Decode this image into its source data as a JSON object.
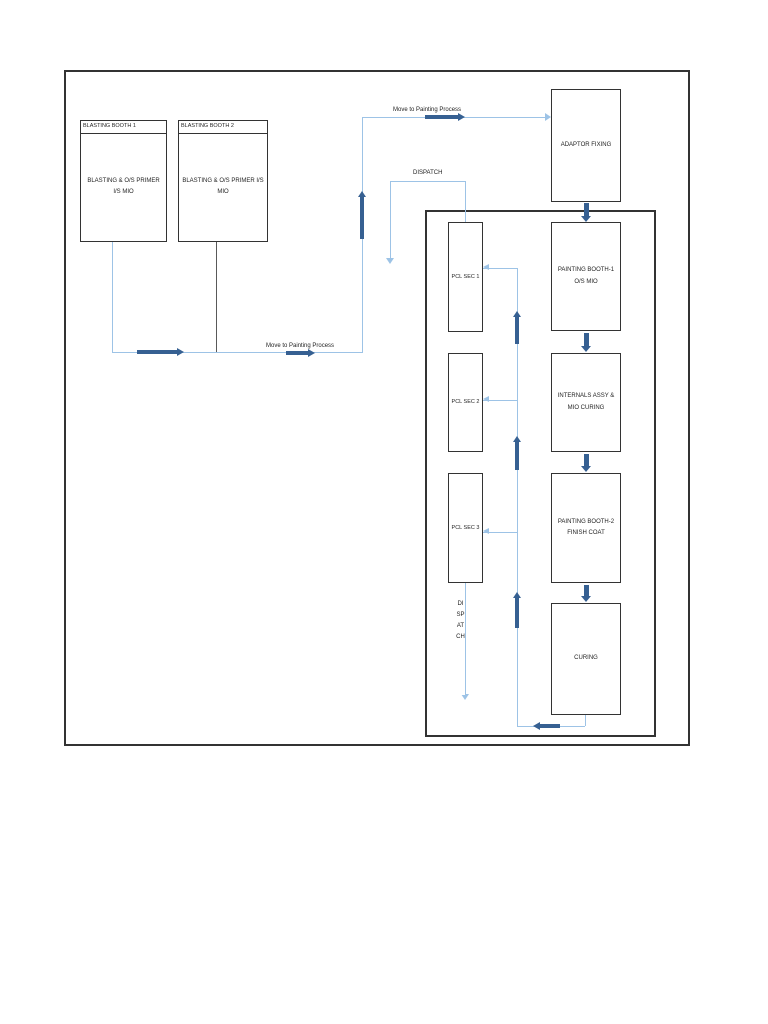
{
  "colors": {
    "line_light": "#9DC3E6",
    "arrow_dark": "#366092",
    "box_border": "#333333",
    "text": "#1f1f1f",
    "booth2_drop": "#595959"
  },
  "boxes": {
    "blasting_booth_1": {
      "header": "BLASTING BOOTH 1",
      "body_line1": "BLASTING & O/S PRIMER",
      "body_line2": "I/S MIO"
    },
    "blasting_booth_2": {
      "header": "BLASTING BOOTH 2",
      "body_line1": "BLASTING & O/S PRIMER I/S",
      "body_line2": "MIO"
    },
    "adaptor_fixing": {
      "label": "ADAPTOR FIXING"
    },
    "pcl_sec_1": {
      "label": "PCL SEC  1"
    },
    "pcl_sec_2": {
      "label": "PCL SEC  2"
    },
    "pcl_sec_3": {
      "label": "PCL SEC  3"
    },
    "painting_booth_1": {
      "line1": "PAINTING BOOTH-1",
      "line2": "O/S MIO"
    },
    "internals_assy": {
      "line1": "INTERNALS ASSY &",
      "line2": "MIO CURING"
    },
    "painting_booth_2": {
      "line1": "PAINTING BOOTH-2",
      "line2": "FINISH COAT"
    },
    "curing": {
      "label": "CURING"
    }
  },
  "labels": {
    "move_to_painting_top": "Move to Painting Process",
    "move_to_painting_bottom": "Move to Painting Process",
    "dispatch": "DISPATCH",
    "dispatch_vertical": "DISPATCH"
  }
}
